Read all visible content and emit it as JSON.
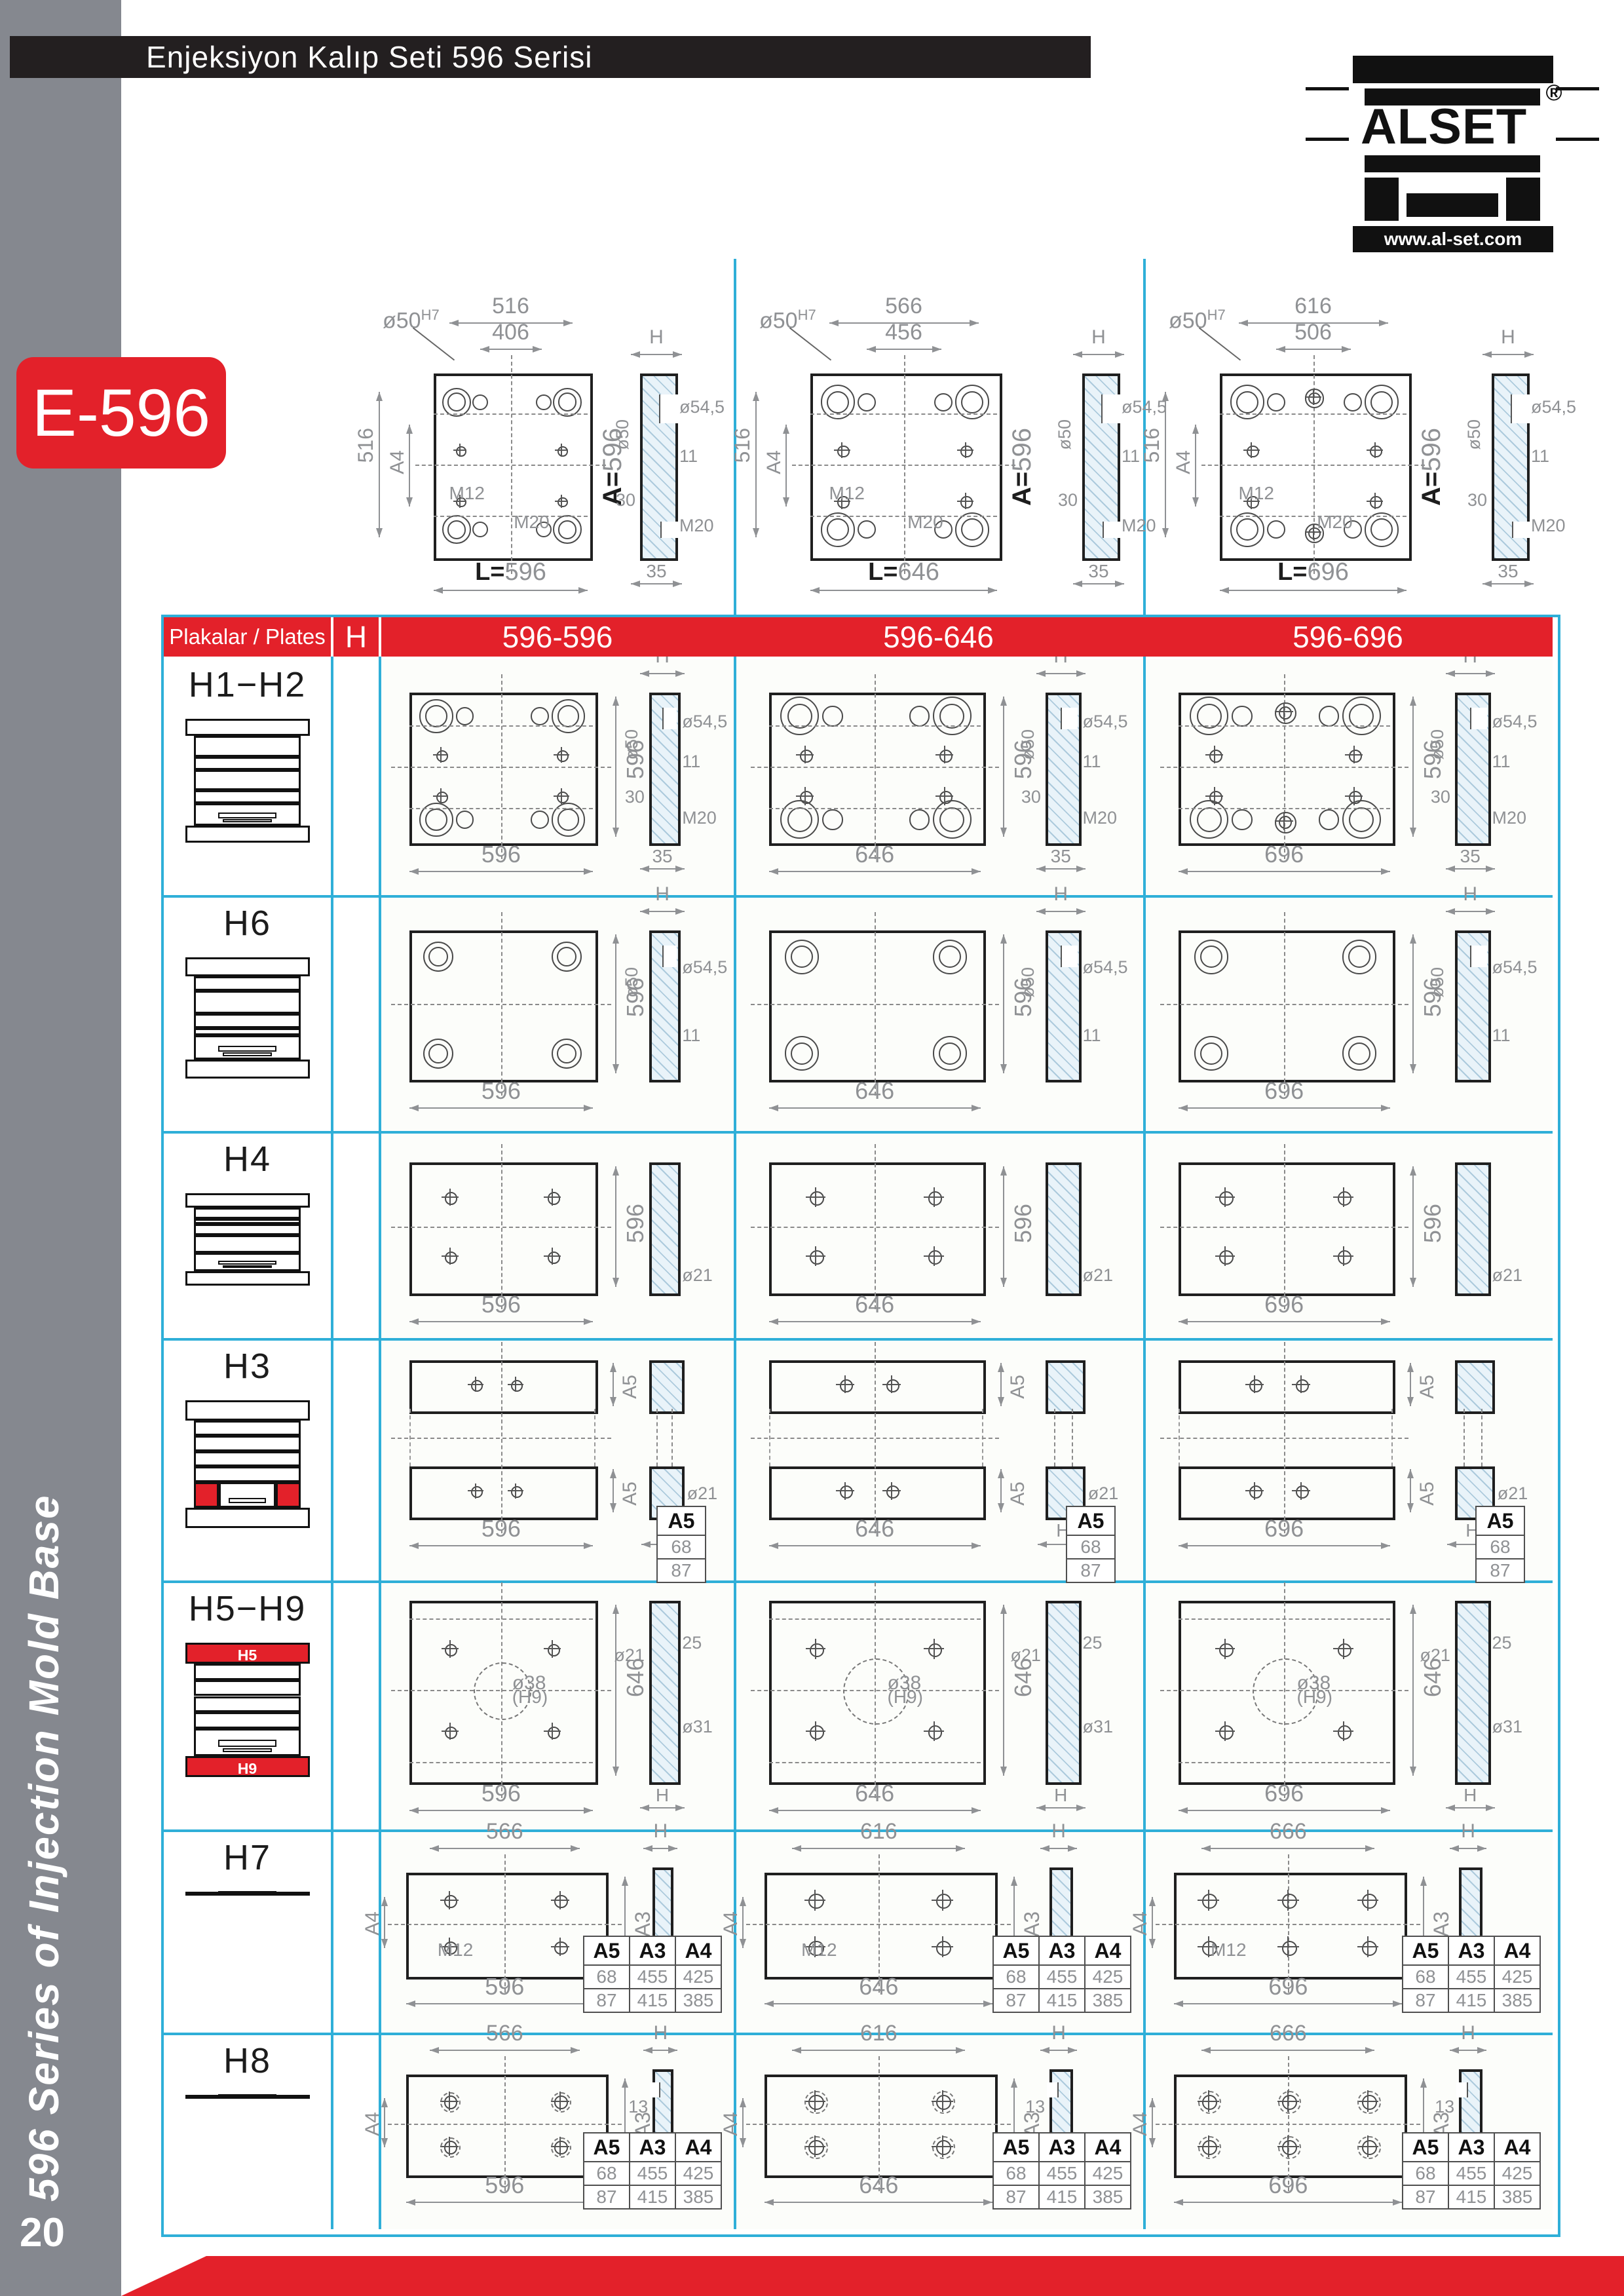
{
  "page": {
    "title": "Enjeksiyon Kalıp Seti 596 Serisi",
    "product_code": "E-596",
    "sidebar_text": "596 Series of Injection Mold Base",
    "page_number": "20",
    "logo": {
      "brand": "ALSET",
      "registered": "®",
      "website": "www.al-set.com"
    }
  },
  "colors": {
    "red": "#e3212a",
    "cyan": "#2fafd8",
    "dark": "#231f20",
    "sidebar_gray": "#85888f"
  },
  "top_drawings": [
    {
      "top_dim_outer": "516",
      "top_dim_inner": "406",
      "left_dim": "516",
      "left_dim_a": "A4",
      "bore_label": "ø50",
      "bore_sup": "H7",
      "m12": "M12",
      "m20": "M20",
      "bottom_dim": "L=596",
      "right_dim": "A=596",
      "holes": "groups4",
      "side": {
        "top": "H",
        "left": [
          "ø50",
          "30"
        ],
        "right": [
          "ø54,5",
          "11",
          "M20"
        ],
        "bottom": "35"
      }
    },
    {
      "top_dim_outer": "566",
      "top_dim_inner": "456",
      "left_dim": "516",
      "left_dim_a": "A4",
      "bore_label": "ø50",
      "bore_sup": "H7",
      "m12": "M12",
      "m20": "M20",
      "bottom_dim": "L=646",
      "right_dim": "A=596",
      "holes": "groups4",
      "side": {
        "top": "H",
        "left": [
          "ø50",
          "30"
        ],
        "right": [
          "ø54,5",
          "11",
          "M20"
        ],
        "bottom": "35"
      }
    },
    {
      "top_dim_outer": "616",
      "top_dim_inner": "506",
      "left_dim": "516",
      "left_dim_a": "A4",
      "bore_label": "ø50",
      "bore_sup": "H7",
      "m12": "M12",
      "m20": "M20",
      "bottom_dim": "L=696",
      "right_dim": "A=596",
      "holes": "groups6",
      "side": {
        "top": "H",
        "left": [
          "ø50",
          "30"
        ],
        "right": [
          "ø54,5",
          "11",
          "M20"
        ],
        "bottom": "35"
      }
    }
  ],
  "table": {
    "header": {
      "plates_label": "Plakalar / Plates",
      "h_label": "H",
      "columns": [
        "596-596",
        "596-646",
        "596-696"
      ]
    },
    "rows": [
      {
        "id": "h1h2",
        "label": "H1−H2",
        "kind": "portrait",
        "h_values": [
          "47",
          "57",
          "67",
          "77",
          "87",
          "97",
          "107",
          "117",
          "127"
        ],
        "icon_layers": [
          [
            "wide",
            ""
          ],
          [
            "red",
            "H1"
          ],
          [
            "white",
            ""
          ],
          [
            "red",
            "H2"
          ],
          [
            "white",
            ""
          ],
          [
            "ubox",
            ""
          ],
          [
            "wide",
            ""
          ]
        ],
        "cells": [
          {
            "holes": "groups4",
            "bottom_dim": "596",
            "right_dim": "596",
            "side": {
              "top": "H",
              "left": [
                "ø50",
                "30"
              ],
              "right": [
                "ø54,5",
                "11",
                "M20"
              ],
              "bottom": "35"
            }
          },
          {
            "holes": "groups4",
            "bottom_dim": "646",
            "right_dim": "596",
            "side": {
              "top": "H",
              "left": [
                "ø50",
                "30"
              ],
              "right": [
                "ø54,5",
                "11",
                "M20"
              ],
              "bottom": "35"
            }
          },
          {
            "holes": "groups6",
            "bottom_dim": "696",
            "right_dim": "596",
            "side": {
              "top": "H",
              "left": [
                "ø50",
                "30"
              ],
              "right": [
                "ø54,5",
                "11",
                "M20"
              ],
              "bottom": "35"
            }
          }
        ]
      },
      {
        "id": "h6",
        "label": "H6",
        "kind": "portrait",
        "h_values": [
          "47",
          "57",
          "67",
          "77",
          "87",
          "97",
          "107",
          "117",
          "127"
        ],
        "icon_layers": [
          [
            "wide",
            ""
          ],
          [
            "white",
            ""
          ],
          [
            "red",
            "H6"
          ],
          [
            "white",
            ""
          ],
          [
            "thin",
            ""
          ],
          [
            "ubox",
            ""
          ],
          [
            "wide",
            ""
          ]
        ],
        "cells": [
          {
            "holes": "rings4",
            "bottom_dim": "596",
            "right_dim": "596",
            "side": {
              "top": "H",
              "left": [
                "ø50"
              ],
              "right": [
                "ø54,5",
                "11"
              ]
            }
          },
          {
            "holes": "rings4",
            "bottom_dim": "646",
            "right_dim": "596",
            "side": {
              "top": "H",
              "left": [
                "ø50"
              ],
              "right": [
                "ø54,5",
                "11"
              ]
            }
          },
          {
            "holes": "rings4",
            "bottom_dim": "696",
            "right_dim": "596",
            "side": {
              "top": "H",
              "left": [
                "ø50"
              ],
              "right": [
                "ø54,5",
                "11"
              ]
            }
          }
        ]
      },
      {
        "id": "h4",
        "label": "H4",
        "kind": "portrait",
        "h_values": [
          "47",
          "57",
          "67",
          "77",
          "87"
        ],
        "icon_layers": [
          [
            "wide",
            ""
          ],
          [
            "white",
            ""
          ],
          [
            "thin",
            ""
          ],
          [
            "white",
            ""
          ],
          [
            "red",
            "H4"
          ],
          [
            "ubox",
            ""
          ],
          [
            "wide",
            ""
          ]
        ],
        "cells": [
          {
            "holes": "crosses4",
            "bottom_dim": "596",
            "right_dim": "596",
            "side": {
              "right": [
                "ø21"
              ]
            }
          },
          {
            "holes": "crosses4",
            "bottom_dim": "646",
            "right_dim": "596",
            "side": {
              "right": [
                "ø21"
              ]
            }
          },
          {
            "holes": "crosses4",
            "bottom_dim": "696",
            "right_dim": "596",
            "side": {
              "right": [
                "ø21"
              ]
            }
          }
        ]
      },
      {
        "id": "h3",
        "label": "H3",
        "kind": "h3",
        "h_values": [
          "77",
          "87",
          "97",
          "107",
          "117",
          "127",
          "137"
        ],
        "icon_layers": [
          [
            "wide",
            ""
          ],
          [
            "white",
            ""
          ],
          [
            "white",
            ""
          ],
          [
            "white",
            ""
          ],
          [
            "white",
            ""
          ],
          [
            "rails",
            ""
          ],
          [
            "wide",
            ""
          ]
        ],
        "cells": [
          {
            "bottom_dim": "596",
            "strip_label": "A5",
            "side": {
              "right": [
                "ø21"
              ],
              "bottom": "H"
            },
            "mini_table": {
              "headers": [
                "A5"
              ],
              "rows": [
                [
                  "68"
                ],
                [
                  "87"
                ]
              ]
            }
          },
          {
            "bottom_dim": "646",
            "strip_label": "A5",
            "side": {
              "right": [
                "ø21"
              ],
              "bottom": "H"
            },
            "mini_table": {
              "headers": [
                "A5"
              ],
              "rows": [
                [
                  "68"
                ],
                [
                  "87"
                ]
              ]
            }
          },
          {
            "bottom_dim": "696",
            "strip_label": "A5",
            "side": {
              "right": [
                "ø21"
              ],
              "bottom": "H"
            },
            "mini_table": {
              "headers": [
                "A5"
              ],
              "rows": [
                [
                  "68"
                ],
                [
                  "87"
                ]
              ]
            }
          }
        ]
      },
      {
        "id": "h5h9",
        "label": "H5−H9",
        "kind": "h5h9",
        "h_values": [
          "47",
          "57",
          "67",
          "77"
        ],
        "icon_layers": [
          [
            "redwide",
            "H5"
          ],
          [
            "white",
            ""
          ],
          [
            "white",
            ""
          ],
          [
            "white",
            ""
          ],
          [
            "white",
            ""
          ],
          [
            "ubox",
            ""
          ],
          [
            "redwide",
            "H9"
          ]
        ],
        "cells": [
          {
            "holes": "crosses4",
            "bottom_dim": "596",
            "right_dim": "646",
            "center_label": "ø38",
            "center_label2": "(H9)",
            "side": {
              "left": [
                "ø21"
              ],
              "right": [
                "25",
                "ø31"
              ],
              "bottom": "H"
            }
          },
          {
            "holes": "crosses4",
            "bottom_dim": "646",
            "right_dim": "646",
            "center_label": "ø38",
            "center_label2": "(H9)",
            "side": {
              "left": [
                "ø21"
              ],
              "right": [
                "25",
                "ø31"
              ],
              "bottom": "H"
            }
          },
          {
            "holes": "crosses4",
            "bottom_dim": "696",
            "right_dim": "646",
            "center_label": "ø38",
            "center_label2": "(H9)",
            "side": {
              "left": [
                "ø21"
              ],
              "right": [
                "25",
                "ø31"
              ],
              "bottom": "H"
            }
          }
        ]
      },
      {
        "id": "h7",
        "label": "H7",
        "kind": "land",
        "h_values": [
          "22",
          "27",
          "37"
        ],
        "icon_layers": [
          [
            "wide",
            ""
          ],
          [
            "white",
            ""
          ],
          [
            "white",
            ""
          ],
          [
            "white",
            ""
          ],
          [
            "uboxred",
            ""
          ],
          [
            "wide",
            ""
          ]
        ],
        "cells": [
          {
            "holes": "crosses4",
            "top_dim": "566",
            "bottom_dim": "596",
            "left_dim": "A4",
            "right_dim": "A3",
            "m12": "M12",
            "side": {
              "top": "H",
              "right": [
                "M12"
              ]
            },
            "mini_table": {
              "headers": [
                "A5",
                "A3",
                "A4"
              ],
              "rows": [
                [
                  "68",
                  "455",
                  "425"
                ],
                [
                  "87",
                  "415",
                  "385"
                ]
              ]
            }
          },
          {
            "holes": "crosses4",
            "top_dim": "616",
            "bottom_dim": "646",
            "left_dim": "A4",
            "right_dim": "A3",
            "m12": "M12",
            "side": {
              "top": "H",
              "right": [
                "M12"
              ]
            },
            "mini_table": {
              "headers": [
                "A5",
                "A3",
                "A4"
              ],
              "rows": [
                [
                  "68",
                  "455",
                  "425"
                ],
                [
                  "87",
                  "415",
                  "385"
                ]
              ]
            }
          },
          {
            "holes": "crosses6",
            "top_dim": "666",
            "bottom_dim": "696",
            "left_dim": "A4",
            "right_dim": "A3",
            "m12": "M12",
            "side": {
              "top": "H",
              "right": [
                "M12"
              ]
            },
            "mini_table": {
              "headers": [
                "A5",
                "A3",
                "A4"
              ],
              "rows": [
                [
                  "68",
                  "455",
                  "425"
                ],
                [
                  "87",
                  "415",
                  "385"
                ]
              ]
            }
          }
        ]
      },
      {
        "id": "h8",
        "label": "H8",
        "kind": "land",
        "h_values": [
          "27",
          "37",
          "47"
        ],
        "icon_layers": [
          [
            "wide",
            ""
          ],
          [
            "white",
            ""
          ],
          [
            "white",
            ""
          ],
          [
            "white",
            ""
          ],
          [
            "uboxred",
            ""
          ],
          [
            "wide",
            ""
          ]
        ],
        "cells": [
          {
            "holes": "crosses4d",
            "top_dim": "566",
            "bottom_dim": "596",
            "left_dim": "A4",
            "right_dim": "A3",
            "dim13": "13",
            "side": {
              "top": "H",
              "left": [
                "13",
                "ø18,5"
              ],
              "right": [
                "ø12,5"
              ]
            },
            "mini_table": {
              "headers": [
                "A5",
                "A3",
                "A4"
              ],
              "rows": [
                [
                  "68",
                  "455",
                  "425"
                ],
                [
                  "87",
                  "415",
                  "385"
                ]
              ]
            }
          },
          {
            "holes": "crosses4d",
            "top_dim": "616",
            "bottom_dim": "646",
            "left_dim": "A4",
            "right_dim": "A3",
            "dim13": "13",
            "side": {
              "top": "H",
              "left": [
                "13",
                "ø18,5"
              ],
              "right": [
                "ø12,5"
              ]
            },
            "mini_table": {
              "headers": [
                "A5",
                "A3",
                "A4"
              ],
              "rows": [
                [
                  "68",
                  "455",
                  "425"
                ],
                [
                  "87",
                  "415",
                  "385"
                ]
              ]
            }
          },
          {
            "holes": "crosses6d",
            "top_dim": "666",
            "bottom_dim": "696",
            "left_dim": "A4",
            "right_dim": "A3",
            "dim13": "13",
            "side": {
              "top": "H",
              "left": [
                "13",
                "ø18,5"
              ],
              "right": [
                "ø12,5"
              ]
            },
            "mini_table": {
              "headers": [
                "A5",
                "A3",
                "A4"
              ],
              "rows": [
                [
                  "68",
                  "455",
                  "425"
                ],
                [
                  "87",
                  "415",
                  "385"
                ]
              ]
            }
          }
        ]
      }
    ]
  }
}
